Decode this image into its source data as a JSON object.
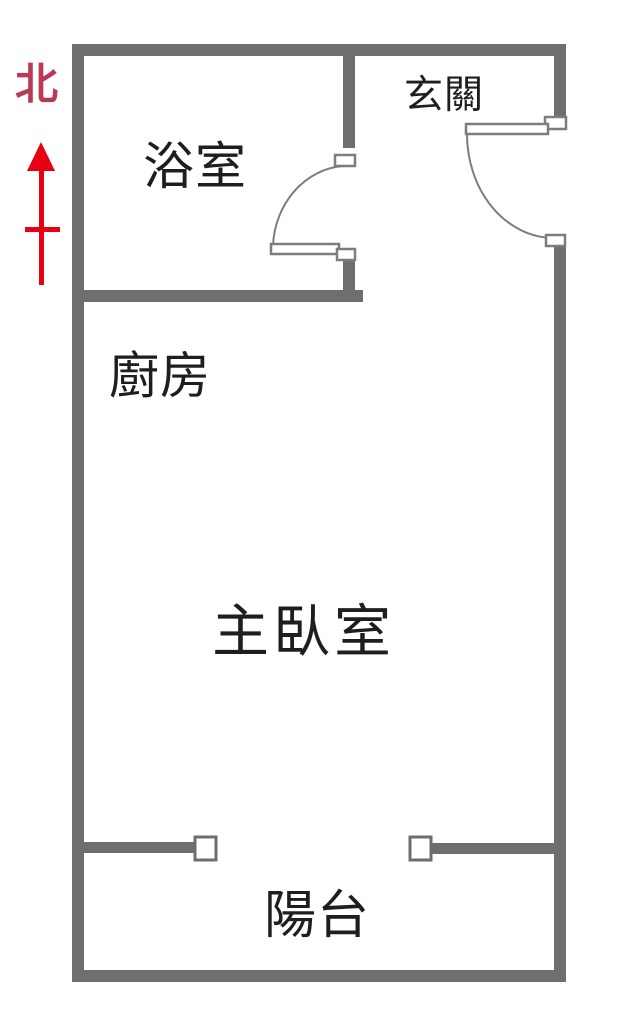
{
  "floor_plan": {
    "north_indicator": {
      "label": "北",
      "label_color": "#b93a52",
      "arrow_color": "#e60012",
      "direction": "up"
    },
    "rooms": [
      {
        "id": "bathroom",
        "label": "浴室"
      },
      {
        "id": "entryway",
        "label": "玄關"
      },
      {
        "id": "kitchen",
        "label": "廚房"
      },
      {
        "id": "master-bedroom",
        "label": "主臥室"
      },
      {
        "id": "balcony",
        "label": "陽台"
      }
    ],
    "colors": {
      "wall": "#6e6e6e",
      "door_line": "#7d7d7d",
      "label_text": "#1e1e1e",
      "background": "#ffffff"
    }
  }
}
